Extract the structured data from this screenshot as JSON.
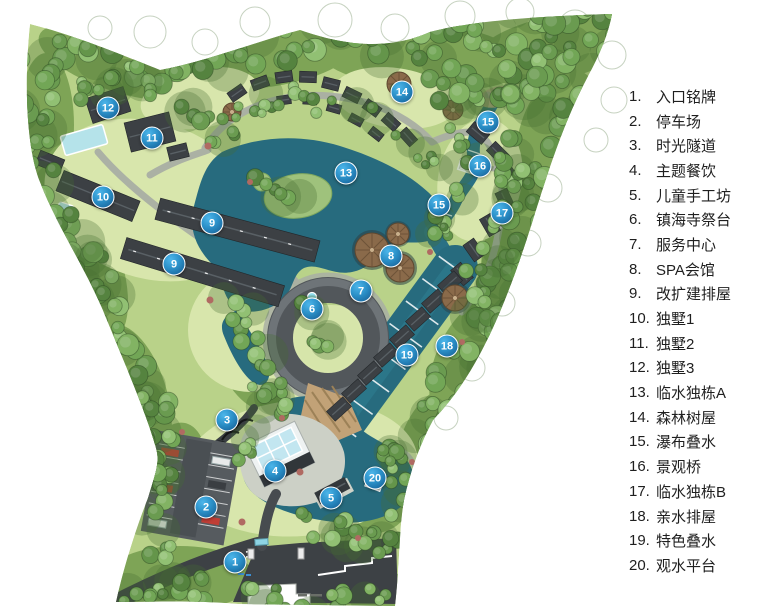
{
  "page": {
    "background": "#ffffff",
    "type": "resort-master-plan"
  },
  "legend": {
    "items": [
      {
        "num": "1.",
        "label": "入口铭牌"
      },
      {
        "num": "2.",
        "label": "停车场"
      },
      {
        "num": "3.",
        "label": "时光隧道"
      },
      {
        "num": "4.",
        "label": "主题餐饮"
      },
      {
        "num": "5.",
        "label": "儿童手工坊"
      },
      {
        "num": "6.",
        "label": "镇海寺祭台"
      },
      {
        "num": "7.",
        "label": "服务中心"
      },
      {
        "num": "8.",
        "label": "SPA会馆"
      },
      {
        "num": "9.",
        "label": "改扩建排屋"
      },
      {
        "num": "10.",
        "label": "独墅1"
      },
      {
        "num": "11.",
        "label": "独墅2"
      },
      {
        "num": "12.",
        "label": "独墅3"
      },
      {
        "num": "13.",
        "label": "临水独栋A"
      },
      {
        "num": "14.",
        "label": "森林树屋"
      },
      {
        "num": "15.",
        "label": "瀑布叠水"
      },
      {
        "num": "16.",
        "label": "景观桥"
      },
      {
        "num": "17.",
        "label": "临水独栋B"
      },
      {
        "num": "18.",
        "label": "亲水排屋"
      },
      {
        "num": "19.",
        "label": "特色叠水"
      },
      {
        "num": "20.",
        "label": "观水平台"
      }
    ]
  },
  "map": {
    "marker_color_top": "#4db6ea",
    "marker_color_bottom": "#14598f",
    "lake_color": "#276b7e",
    "markers": [
      {
        "n": "1",
        "x": 235,
        "y": 562,
        "label": "入口铭牌"
      },
      {
        "n": "2",
        "x": 206,
        "y": 507,
        "label": "停车场"
      },
      {
        "n": "3",
        "x": 227,
        "y": 420,
        "label": "时光隧道"
      },
      {
        "n": "4",
        "x": 275,
        "y": 471,
        "label": "主题餐饮"
      },
      {
        "n": "5",
        "x": 331,
        "y": 498,
        "label": "儿童手工坊"
      },
      {
        "n": "6",
        "x": 312,
        "y": 309,
        "label": "镇海寺祭台"
      },
      {
        "n": "7",
        "x": 361,
        "y": 291,
        "label": "服务中心"
      },
      {
        "n": "8",
        "x": 391,
        "y": 256,
        "label": "SPA会馆"
      },
      {
        "n": "9",
        "x": 212,
        "y": 223,
        "label": "改扩建排屋"
      },
      {
        "n": "9",
        "x": 174,
        "y": 264,
        "label": "改扩建排屋"
      },
      {
        "n": "10",
        "x": 103,
        "y": 197,
        "label": "独墅1"
      },
      {
        "n": "11",
        "x": 152,
        "y": 138,
        "label": "独墅2"
      },
      {
        "n": "12",
        "x": 108,
        "y": 108,
        "label": "独墅3"
      },
      {
        "n": "13",
        "x": 346,
        "y": 173,
        "label": "临水独栋A"
      },
      {
        "n": "14",
        "x": 402,
        "y": 92,
        "label": "森林树屋"
      },
      {
        "n": "15",
        "x": 488,
        "y": 122,
        "label": "瀑布叠水"
      },
      {
        "n": "15",
        "x": 439,
        "y": 205,
        "label": "瀑布叠水"
      },
      {
        "n": "16",
        "x": 480,
        "y": 166,
        "label": "景观桥"
      },
      {
        "n": "17",
        "x": 502,
        "y": 213,
        "label": "临水独栋B"
      },
      {
        "n": "18",
        "x": 447,
        "y": 346,
        "label": "亲水排屋"
      },
      {
        "n": "19",
        "x": 407,
        "y": 355,
        "label": "特色叠水"
      },
      {
        "n": "20",
        "x": 375,
        "y": 478,
        "label": "观水平台"
      }
    ]
  }
}
